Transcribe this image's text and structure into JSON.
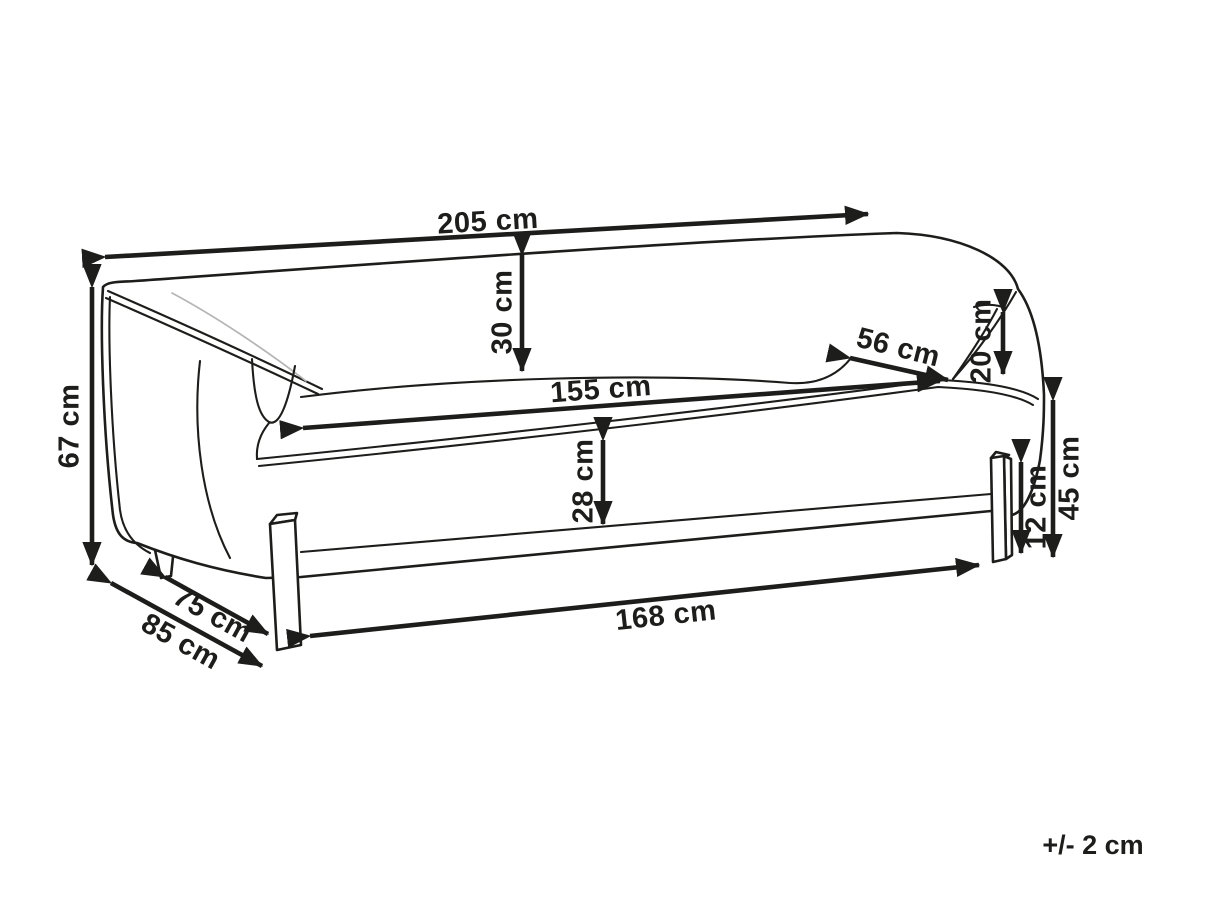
{
  "diagram": {
    "title": "sofa-dimension-drawing",
    "unit": "cm",
    "tolerance_note": "+/- 2 cm",
    "colors": {
      "line": "#1d1d1b",
      "background": "#ffffff",
      "crease": "#b5b5b5"
    },
    "dimensions": [
      {
        "id": "overall-width",
        "label": "205 cm",
        "value": 205
      },
      {
        "id": "backrest-height-above-seat",
        "label": "30 cm",
        "value": 30
      },
      {
        "id": "seat-depth",
        "label": "56 cm",
        "value": 56
      },
      {
        "id": "armrest-height-above-seat",
        "label": "20 cm",
        "value": 20
      },
      {
        "id": "seat-width",
        "label": "155 cm",
        "value": 155
      },
      {
        "id": "overall-height",
        "label": "67 cm",
        "value": 67
      },
      {
        "id": "seat-front-height",
        "label": "28 cm",
        "value": 28
      },
      {
        "id": "seat-height-from-floor",
        "label": "45 cm",
        "value": 45
      },
      {
        "id": "leg-clearance-height",
        "label": "12 cm",
        "value": 12
      },
      {
        "id": "base-width",
        "label": "168 cm",
        "value": 168
      },
      {
        "id": "floor-depth",
        "label": "75 cm",
        "value": 75
      },
      {
        "id": "overall-depth",
        "label": "85 cm",
        "value": 85
      }
    ]
  }
}
